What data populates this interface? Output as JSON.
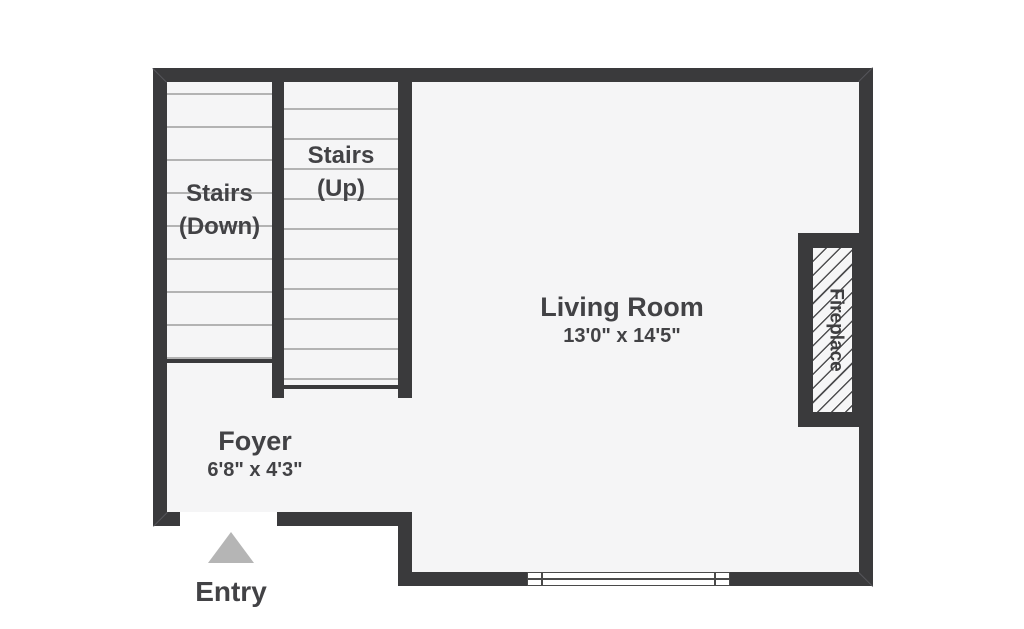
{
  "title": "First floor plan",
  "colors": {
    "wall": "#3a3a3c",
    "floor": "#f5f5f6",
    "outside": "#ffffff",
    "text": "#424245",
    "stair_tread_line": "#b3b3b3",
    "entry_arrow": "#b5b5b5",
    "fireplace_hatch": "#4f4f51"
  },
  "rooms": {
    "living_room": {
      "label": "Living Room",
      "dimensions": "13'0\" x 14'5\""
    },
    "foyer": {
      "label": "Foyer",
      "dimensions": "6'8\" x 4'3\""
    }
  },
  "stairs": {
    "down": {
      "line1": "Stairs",
      "line2": "(Down)"
    },
    "up": {
      "line1": "Stairs",
      "line2": "(Up)"
    }
  },
  "features": {
    "fireplace": {
      "label": "Fireplace"
    },
    "entry": {
      "label": "Entry"
    },
    "window": {
      "type": "window"
    },
    "entry_arrow_icon": "up-triangle"
  }
}
